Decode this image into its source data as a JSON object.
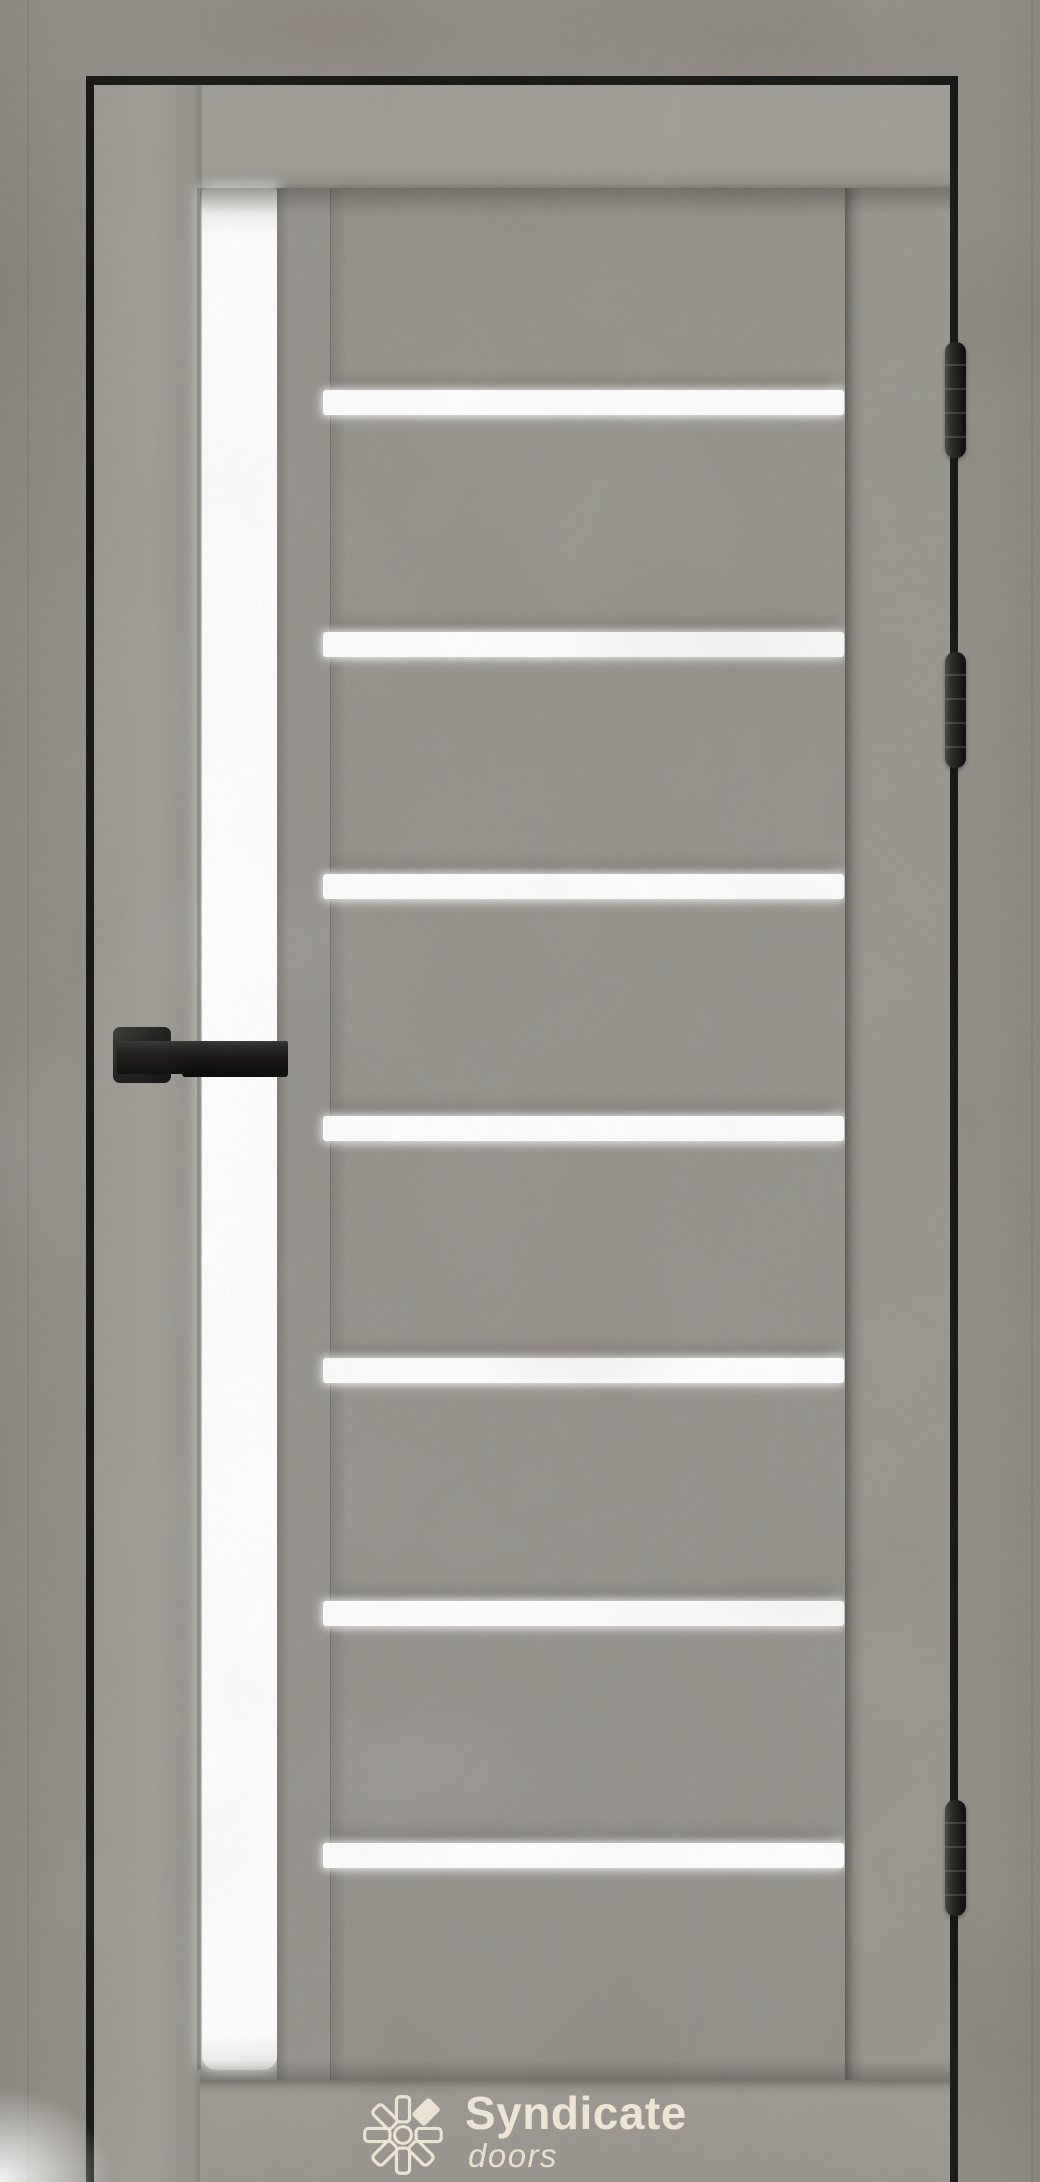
{
  "image": {
    "kind": "product-photo",
    "subject": "interior door, gray concrete finish, frosted white glass inserts",
    "background": "gray concrete wall with black frame reveal"
  },
  "brand": {
    "name": "Syndicate",
    "tagline": "doors",
    "logo_color": "#f1e8d7",
    "logo_icon": "sunburst-asterisk"
  },
  "door": {
    "colors": {
      "wall": "#8e8a83",
      "leaf": "#95928b",
      "stile": "#9b9890",
      "panel": "#93908a",
      "bottom_rail": "#9a968f",
      "gap_line": "#0d0c0a",
      "hardware_black": "#141312",
      "glass_white": "#ffffff"
    },
    "glass": {
      "vertical_strip": {
        "left": 202,
        "top": 188,
        "width": 75,
        "bottom": 2070
      },
      "horizontal_strips": {
        "tops": [
          390,
          632,
          874,
          1116,
          1358,
          1601,
          1843
        ],
        "height": 25
      }
    },
    "hinges": {
      "count": 3,
      "tops": [
        342,
        652,
        1800
      ],
      "height": 116
    },
    "handle": {
      "style": "square-rosette straight lever",
      "finish": "matte black"
    }
  }
}
